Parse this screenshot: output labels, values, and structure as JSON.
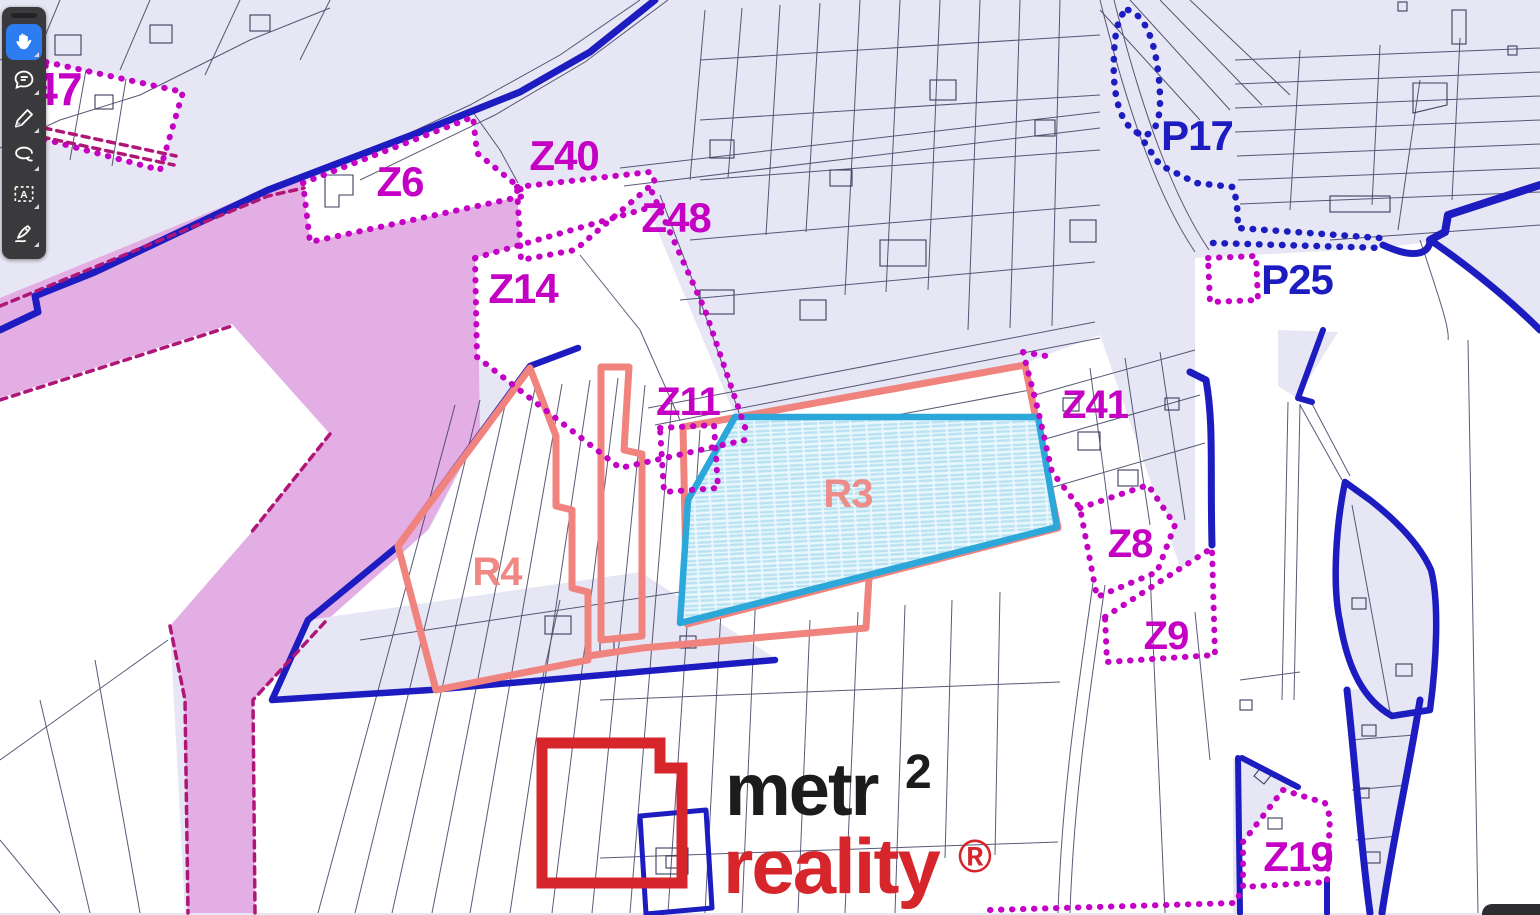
{
  "app": {
    "description": "cadastral zoning map viewer with annotation toolbar"
  },
  "toolbar": {
    "selected_tool": "hand",
    "tools": [
      {
        "name": "hand",
        "icon": "hand-icon",
        "selected": true
      },
      {
        "name": "note",
        "icon": "speech-bubble-icon",
        "selected": false
      },
      {
        "name": "draw",
        "icon": "pencil-icon",
        "selected": false
      },
      {
        "name": "lasso",
        "icon": "lasso-icon",
        "selected": false
      },
      {
        "name": "text-select",
        "icon": "text-select-icon",
        "selected": false
      },
      {
        "name": "sign",
        "icon": "signature-pen-icon",
        "selected": false
      }
    ]
  },
  "map": {
    "zone_labels": [
      {
        "text": "47",
        "color": "magenta"
      },
      {
        "text": "Z6",
        "color": "magenta"
      },
      {
        "text": "Z40",
        "color": "magenta"
      },
      {
        "text": "Z48",
        "color": "magenta"
      },
      {
        "text": "Z14",
        "color": "magenta"
      },
      {
        "text": "Z11",
        "color": "magenta"
      },
      {
        "text": "Z41",
        "color": "magenta"
      },
      {
        "text": "P17",
        "color": "blue"
      },
      {
        "text": "P25",
        "color": "blue"
      },
      {
        "text": "Z8",
        "color": "magenta"
      },
      {
        "text": "Z9",
        "color": "magenta"
      },
      {
        "text": "Z19",
        "color": "magenta"
      },
      {
        "text": "R3",
        "color": "salmon"
      },
      {
        "text": "R4",
        "color": "salmon"
      }
    ]
  },
  "logo": {
    "word1": "metr",
    "sup": "2",
    "word2": "reality",
    "reg": "®"
  },
  "colors": {
    "magenta": "#c400c4",
    "blue": "#1c1cc0",
    "salmon": "#f0837d",
    "cyan": "#2ba7da",
    "cyan_fill": "#eaf7fc",
    "pink_band": "#e3aee3",
    "lavender": "#e6e6f4",
    "parcel_line": "#3d3d60",
    "dark_magenta": "#b01578",
    "logo_red": "#d6252b",
    "logo_black": "#1c1c1c",
    "toolbar_bg": "#3a3a3c",
    "tool_selected": "#2d7cf0"
  }
}
